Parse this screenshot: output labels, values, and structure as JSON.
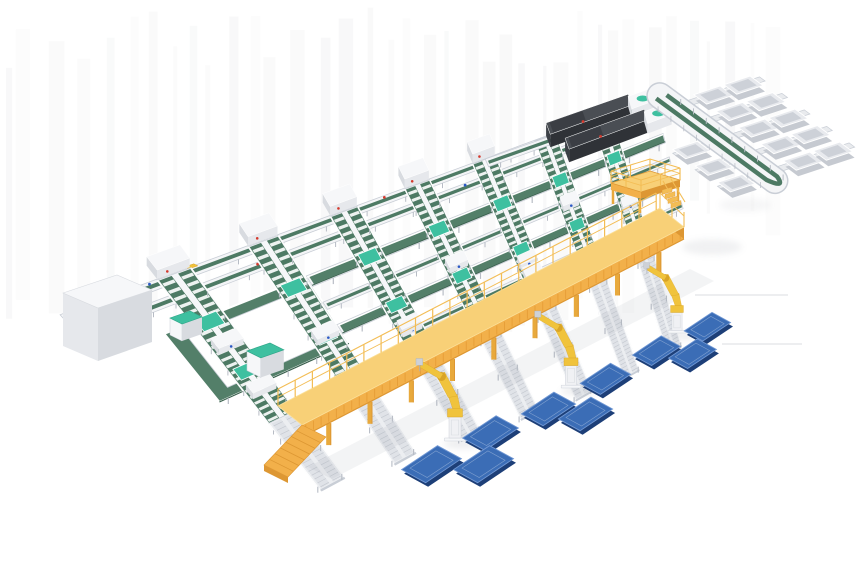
{
  "meta": {
    "title": "Automated parcel sorting and robotic palletizing line - 3D isometric render",
    "canvas": {
      "width": 860,
      "height": 580
    },
    "background": "#ffffff"
  },
  "palette": {
    "laneGreen": "#4d7a64",
    "laneGreenDark": "#3a614e",
    "wideBelt": "#537f69",
    "beltEdge": "#6d947f",
    "frameWhite": "#f4f5f7",
    "frameGray": "#c9ced6",
    "legGray": "#b7bcc5",
    "rollerBase": "#eceef1",
    "rollerLane": "#e0e3e8",
    "rollerLine": "#c6cad1",
    "teal": "#3ec0a0",
    "tealDark": "#2da587",
    "gantryTop": "#f8d077",
    "gantryFace": "#f2b04a",
    "gantryShade": "#dd9733",
    "gantryLeg": "#e8a93c",
    "railYellow": "#f3bd55",
    "robotYellow": "#f0c33c",
    "robotShade": "#d9a426",
    "pedestal": "#f0f1f4",
    "panelBlue": "#3b6db6",
    "panelLight": "#7097d3",
    "panelDark": "#1d3f78",
    "machineTop": "#4a4e54",
    "machineFront": "#2f3237",
    "machineSide": "#3c4046",
    "offWhite": "#f6f7f9",
    "grayFace": "#e6e8ec",
    "graySide": "#d8dbe0",
    "accentRed": "#d43a2e",
    "accentBlue": "#2b59c6",
    "shadow": "#8c919b",
    "stripe": "#70747c",
    "faintLine": "#e2e3e6",
    "white": "#ffffff"
  },
  "scene": {
    "branches": {
      "count": 7,
      "a_positions": [
        60,
        135,
        210,
        285,
        360,
        435,
        510
      ],
      "lane_end": 212,
      "heads_on": [
        0,
        1,
        2,
        3,
        4
      ]
    },
    "spines": [
      {
        "b": 0,
        "a0": -25,
        "a1": 595,
        "type": "thin"
      },
      {
        "b": 20,
        "a0": -25,
        "a1": 585,
        "type": "thin"
      },
      {
        "b": 55,
        "a0": 150,
        "a1": 585,
        "type": "wide"
      },
      {
        "b": 90,
        "a0": 150,
        "a1": 585,
        "type": "thin"
      },
      {
        "b": 123,
        "a0": 150,
        "a1": 560,
        "type": "wide"
      },
      {
        "b": 165,
        "a0": 200,
        "a1": 585,
        "type": "thin"
      }
    ],
    "loop": {
      "a0": 25,
      "b0": 55,
      "a1": 150,
      "b1": 150
    },
    "gantry": {
      "x0": 302,
      "y0": 459,
      "x1": 684,
      "y1": 261,
      "height": 34,
      "face": 12,
      "depth": [
        -24,
        -19
      ],
      "legs": 9
    },
    "robots": [
      {
        "x": 455,
        "y": 441,
        "s": 0.75
      },
      {
        "x": 571,
        "y": 388,
        "s": 0.7
      },
      {
        "x": 677,
        "y": 333,
        "s": 0.64
      }
    ],
    "panels": [
      {
        "x": 707,
        "y": 325,
        "s": 0.58
      },
      {
        "x": 656,
        "y": 349,
        "s": 0.6
      },
      {
        "x": 692,
        "y": 352,
        "s": 0.6
      },
      {
        "x": 605,
        "y": 377,
        "s": 0.63
      },
      {
        "x": 548,
        "y": 407,
        "s": 0.68
      },
      {
        "x": 585,
        "y": 412,
        "s": 0.68
      },
      {
        "x": 490,
        "y": 431,
        "s": 0.7
      },
      {
        "x": 431,
        "y": 462,
        "s": 0.75
      },
      {
        "x": 483,
        "y": 462,
        "s": 0.75
      }
    ],
    "sorter": {
      "ox": 663,
      "oy": 98,
      "vx": 0.8,
      "vy": 0.59,
      "ux": 0.94,
      "uy": -0.31,
      "length": 140,
      "chute_rows_right": [
        16,
        44,
        72,
        100,
        128
      ],
      "chute_rows_left": [
        72,
        100,
        128
      ]
    },
    "platform": {
      "top": [
        [
          611,
          183
        ],
        [
          650,
          171
        ],
        [
          680,
          180
        ],
        [
          641,
          192
        ]
      ],
      "drop": 7,
      "leg": 14,
      "rail": 12
    },
    "machines_offset": [
      15,
      20
    ],
    "cabinet": {
      "top": [
        [
          63,
          293
        ],
        [
          117,
          275
        ],
        [
          152,
          290
        ],
        [
          98,
          308
        ]
      ],
      "hL": 53,
      "hR": 52
    },
    "tealMachines": [
      {
        "x": 170,
        "y": 318,
        "s": 1.0
      },
      {
        "x": 247,
        "y": 351,
        "s": 1.15
      }
    ],
    "faint_lines": [
      [
        695,
        295,
        788,
        295
      ],
      [
        722,
        344,
        802,
        344
      ]
    ]
  },
  "components": [
    {
      "name": "belt-conveyor-branch-line",
      "count": 7
    },
    {
      "name": "cross-transfer-spine-conveyor",
      "count": 6
    },
    {
      "name": "carton-loop-conveyor",
      "count": 1
    },
    {
      "name": "infeed-scanner-machine",
      "count": 2
    },
    {
      "name": "sorter-line-with-chutes",
      "count": 1
    },
    {
      "name": "chute-bin",
      "count": 13
    },
    {
      "name": "maintenance-platform-with-stairs",
      "count": 1
    },
    {
      "name": "elevated-gantry-walkway",
      "count": 1
    },
    {
      "name": "palletizing-robot",
      "count": 3
    },
    {
      "name": "pallet-panel",
      "count": 9
    },
    {
      "name": "roller-outfeed-conveyor",
      "count": 7
    },
    {
      "name": "control-cabinet",
      "count": 1
    },
    {
      "name": "loop-machine-teal-top",
      "count": 2
    }
  ]
}
